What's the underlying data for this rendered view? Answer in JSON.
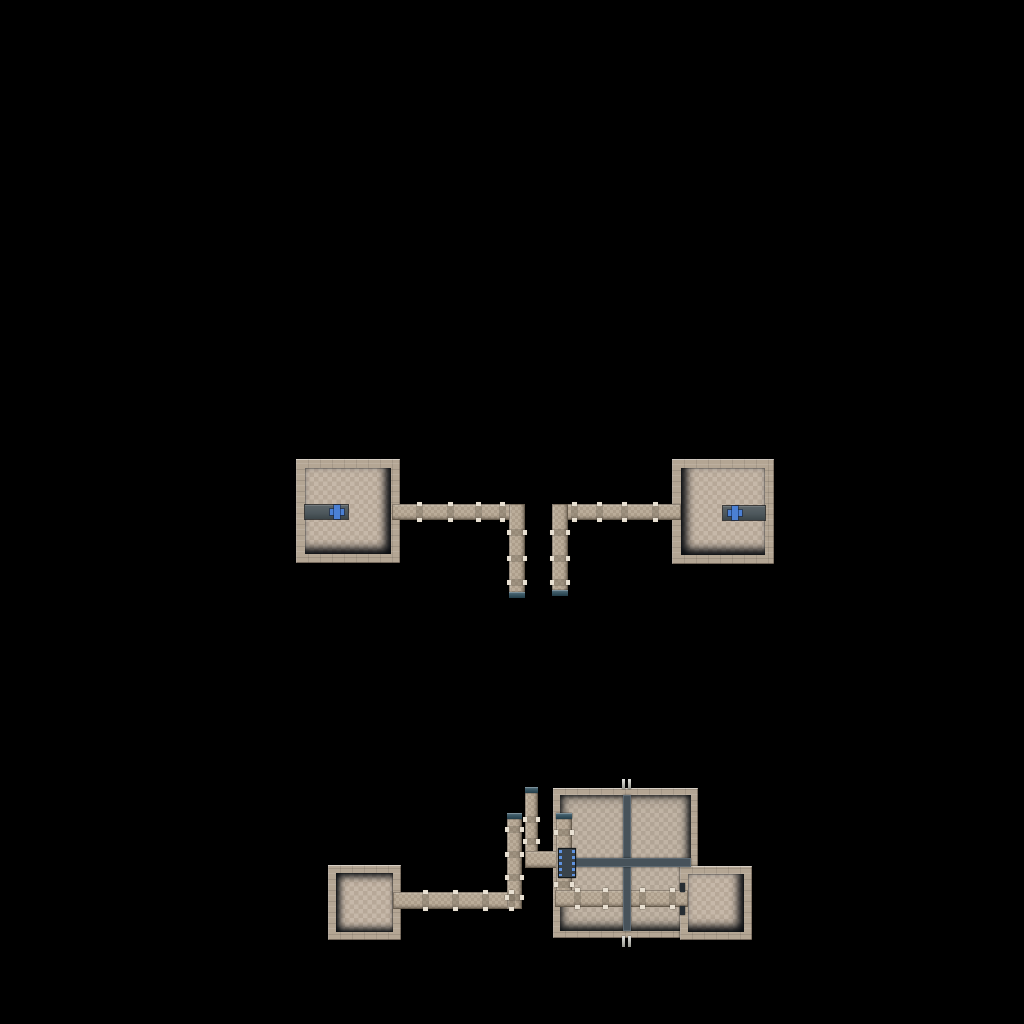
{
  "scene": {
    "title": "top-down-level-map",
    "background_color": "#000000"
  },
  "colors": {
    "wall": "#b4a694",
    "wall_highlight": "#d8cfc0",
    "floor": "#c2b3a2",
    "corridor": "#b7a894",
    "joint_light": "#e8e0d2",
    "slate_platform": "#4e585d",
    "beam": "#47525a",
    "cap_teal": "#3b5763",
    "marker_blue": "#4b80d4",
    "shadow": "#0a0e12"
  },
  "map": {
    "elements": [
      {
        "name": "top-left-room",
        "type": "room",
        "x": 296,
        "y": 459,
        "w": 104,
        "h": 104,
        "wall": 9,
        "shadow": "sh-rb"
      },
      {
        "name": "top-right-room",
        "type": "room",
        "x": 672,
        "y": 459,
        "w": 102,
        "h": 105,
        "wall": 9,
        "shadow": "sh-lb"
      },
      {
        "name": "bottom-large-room",
        "type": "room",
        "x": 553,
        "y": 788,
        "w": 145,
        "h": 150,
        "wall": 7,
        "shadow": "sh-all"
      },
      {
        "name": "bottom-right-room",
        "type": "room",
        "x": 680,
        "y": 866,
        "w": 72,
        "h": 74,
        "wall": 8,
        "shadow": "sh-rb"
      },
      {
        "name": "bottom-left-room",
        "type": "room",
        "x": 328,
        "y": 865,
        "w": 73,
        "h": 75,
        "wall": 8,
        "shadow": "sh-ltb"
      },
      {
        "name": "top-left-corridor-horizontal",
        "type": "corridor",
        "orient": "h",
        "x": 392,
        "y": 504,
        "w": 133,
        "h": 16,
        "joints": [
          25,
          56,
          84,
          108
        ]
      },
      {
        "name": "top-left-corridor-vertical",
        "type": "corridor",
        "orient": "v",
        "x": 509,
        "y": 504,
        "w": 16,
        "h": 94,
        "joints": [
          26,
          52,
          76
        ],
        "cap": "bottom"
      },
      {
        "name": "top-right-corridor-horizontal",
        "type": "corridor",
        "orient": "h",
        "x": 553,
        "y": 504,
        "w": 128,
        "h": 16,
        "joints": [
          19,
          44,
          69,
          100
        ]
      },
      {
        "name": "top-right-corridor-vertical",
        "type": "corridor",
        "orient": "v",
        "x": 552,
        "y": 504,
        "w": 16,
        "h": 92,
        "joints": [
          26,
          52,
          76
        ],
        "cap": "bottom"
      },
      {
        "name": "bottom-left-corridor-horizontal",
        "type": "corridor",
        "orient": "h",
        "x": 393,
        "y": 892,
        "w": 129,
        "h": 17,
        "joints": [
          30,
          60,
          90,
          116
        ]
      },
      {
        "name": "far-left-corridor-vertical",
        "type": "corridor",
        "orient": "v",
        "x": 507,
        "y": 813,
        "w": 15,
        "h": 96,
        "joints": [
          14,
          39,
          62,
          82
        ],
        "cap": "top"
      },
      {
        "name": "elbow-corridor-vertical",
        "type": "corridor",
        "orient": "v",
        "x": 525,
        "y": 787,
        "w": 13,
        "h": 81,
        "joints": [
          30,
          52
        ],
        "cap": "top"
      },
      {
        "name": "elbow-corridor-horizontal",
        "type": "corridor",
        "orient": "h",
        "x": 525,
        "y": 851,
        "w": 35,
        "h": 17,
        "joints": []
      },
      {
        "name": "interior-corridor-vertical",
        "type": "corridor",
        "orient": "v",
        "x": 556,
        "y": 813,
        "w": 16,
        "h": 82,
        "joints": [
          17,
          69
        ],
        "cap": "top"
      },
      {
        "name": "interior-corridor-horizontal",
        "type": "corridor",
        "orient": "h",
        "x": 555,
        "y": 890,
        "w": 133,
        "h": 17,
        "joints": [
          20,
          48,
          85,
          115
        ]
      },
      {
        "name": "floor-beam-vertical",
        "type": "beam",
        "x": 623,
        "y": 795,
        "w": 8,
        "h": 136
      },
      {
        "name": "floor-beam-horizontal",
        "type": "beam",
        "x": 560,
        "y": 858,
        "w": 131,
        "h": 9
      },
      {
        "name": "blue-doorway",
        "type": "door",
        "x": 558,
        "y": 848,
        "w": 18,
        "h": 30
      },
      {
        "name": "left-room-platform",
        "type": "platform",
        "x": 305,
        "y": 505,
        "w": 43,
        "h": 14
      },
      {
        "name": "right-room-platform",
        "type": "platform",
        "x": 723,
        "y": 506,
        "w": 42,
        "h": 14
      },
      {
        "name": "left-blue-cross-marker",
        "type": "cross",
        "x": 330,
        "y": 505,
        "w": 14,
        "h": 14
      },
      {
        "name": "right-blue-cross-marker",
        "type": "cross",
        "x": 728,
        "y": 506,
        "w": 14,
        "h": 14
      },
      {
        "name": "beam-post-top-left",
        "type": "post",
        "x": 622,
        "y": 779,
        "w": 3,
        "h": 10
      },
      {
        "name": "beam-post-top-right",
        "type": "post",
        "x": 628,
        "y": 779,
        "w": 3,
        "h": 10
      },
      {
        "name": "beam-post-bottom-left",
        "type": "post",
        "x": 622,
        "y": 936,
        "w": 3,
        "h": 11
      },
      {
        "name": "beam-post-bottom-right",
        "type": "post",
        "x": 628,
        "y": 936,
        "w": 3,
        "h": 11
      },
      {
        "name": "doorframe-upper",
        "type": "frame",
        "x": 680,
        "y": 883,
        "w": 5,
        "h": 9
      },
      {
        "name": "doorframe-lower",
        "type": "frame",
        "x": 680,
        "y": 906,
        "w": 5,
        "h": 9
      }
    ]
  }
}
